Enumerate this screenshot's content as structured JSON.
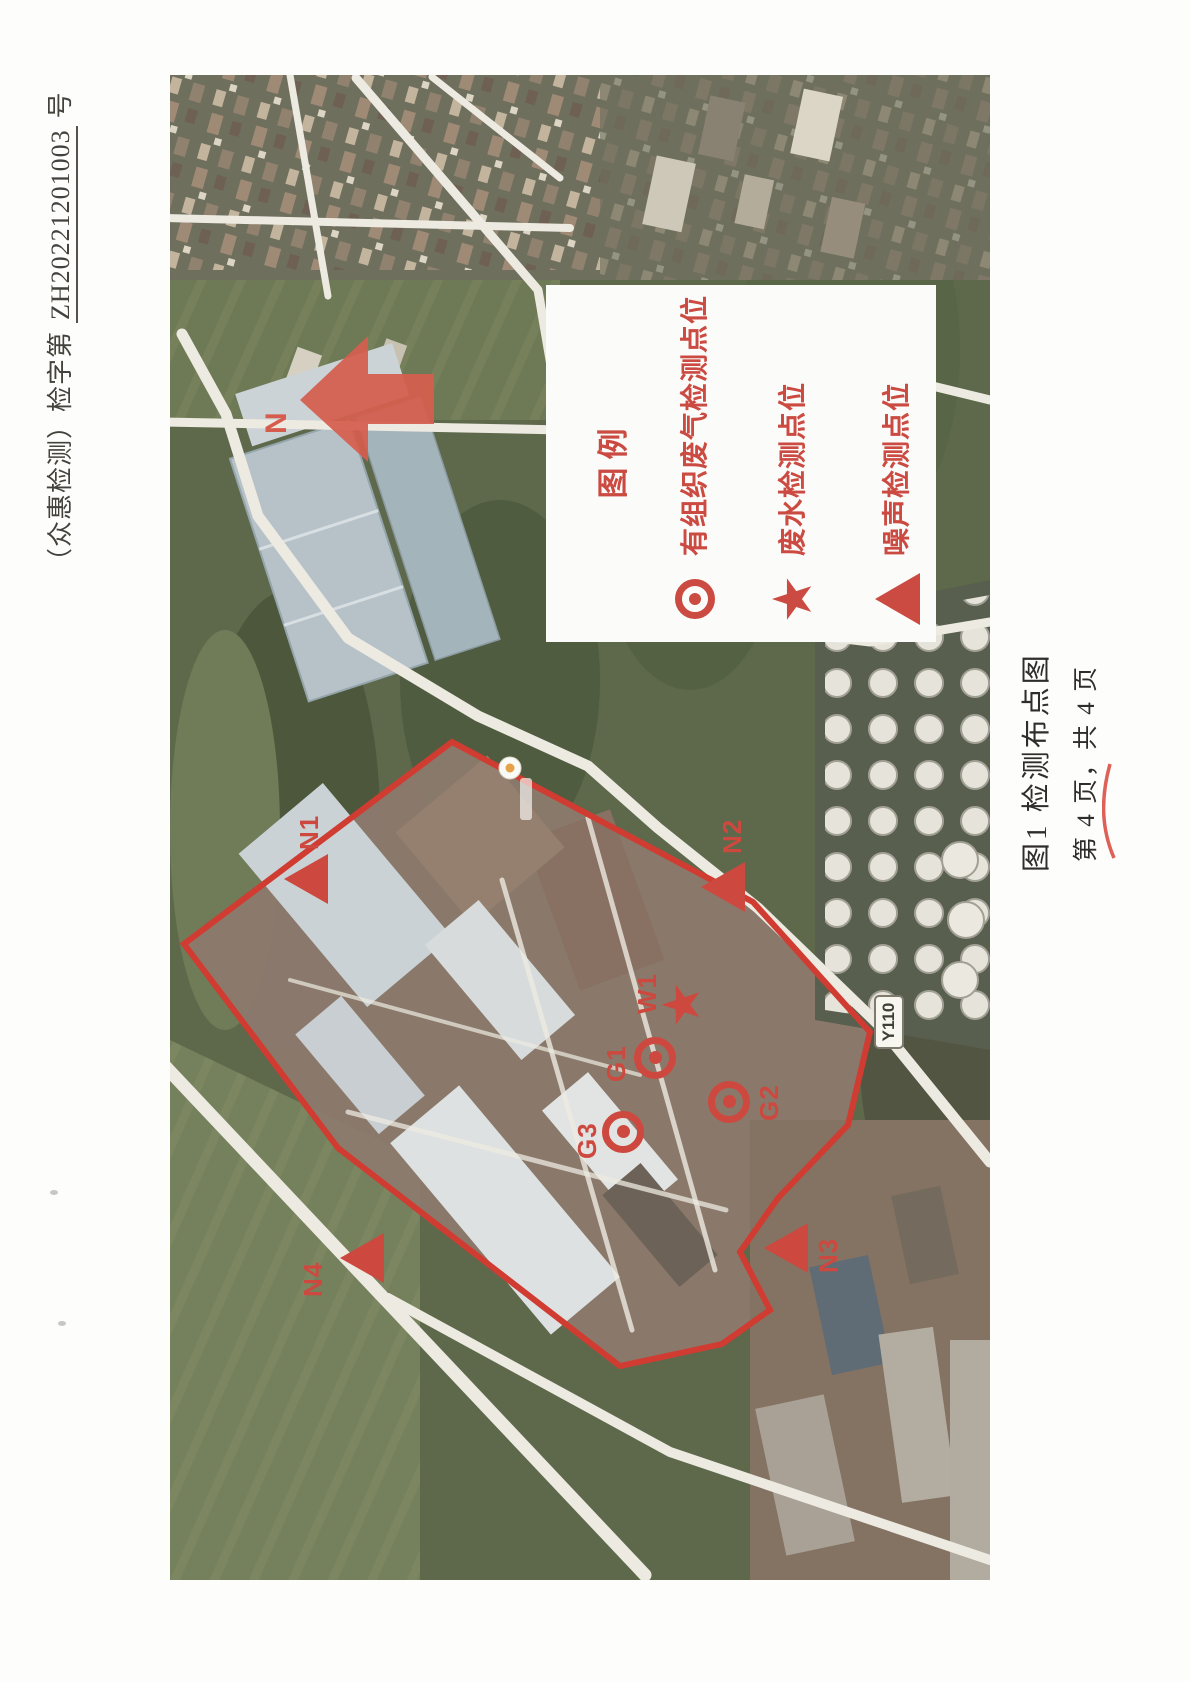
{
  "document": {
    "header_prefix": "（众惠检测）检字第",
    "header_number": "ZH20221201003",
    "header_suffix": "号",
    "figure_caption": "图1  检测布点图",
    "page_indicator": "第 4 页，共 4 页"
  },
  "map": {
    "north_label": "N",
    "road_label": "Y110",
    "legend": {
      "title": "图例",
      "items": [
        {
          "symbol": "double-circle",
          "label": "有组织废气检测点位"
        },
        {
          "symbol": "star",
          "label": "废水检测点位"
        },
        {
          "symbol": "triangle",
          "label": "噪声检测点位"
        }
      ]
    },
    "markers": [
      {
        "id": "N1",
        "type": "noise"
      },
      {
        "id": "N2",
        "type": "noise"
      },
      {
        "id": "N3",
        "type": "noise"
      },
      {
        "id": "N4",
        "type": "noise"
      },
      {
        "id": "W1",
        "type": "wastewater"
      },
      {
        "id": "G1",
        "type": "waste-gas"
      },
      {
        "id": "G2",
        "type": "waste-gas"
      },
      {
        "id": "G3",
        "type": "waste-gas"
      }
    ]
  },
  "colors": {
    "annotation_red": "#d8453a",
    "boundary_red": "#dc382c",
    "arrow_red": "#e05a49",
    "legend_red": "#d6473c"
  }
}
